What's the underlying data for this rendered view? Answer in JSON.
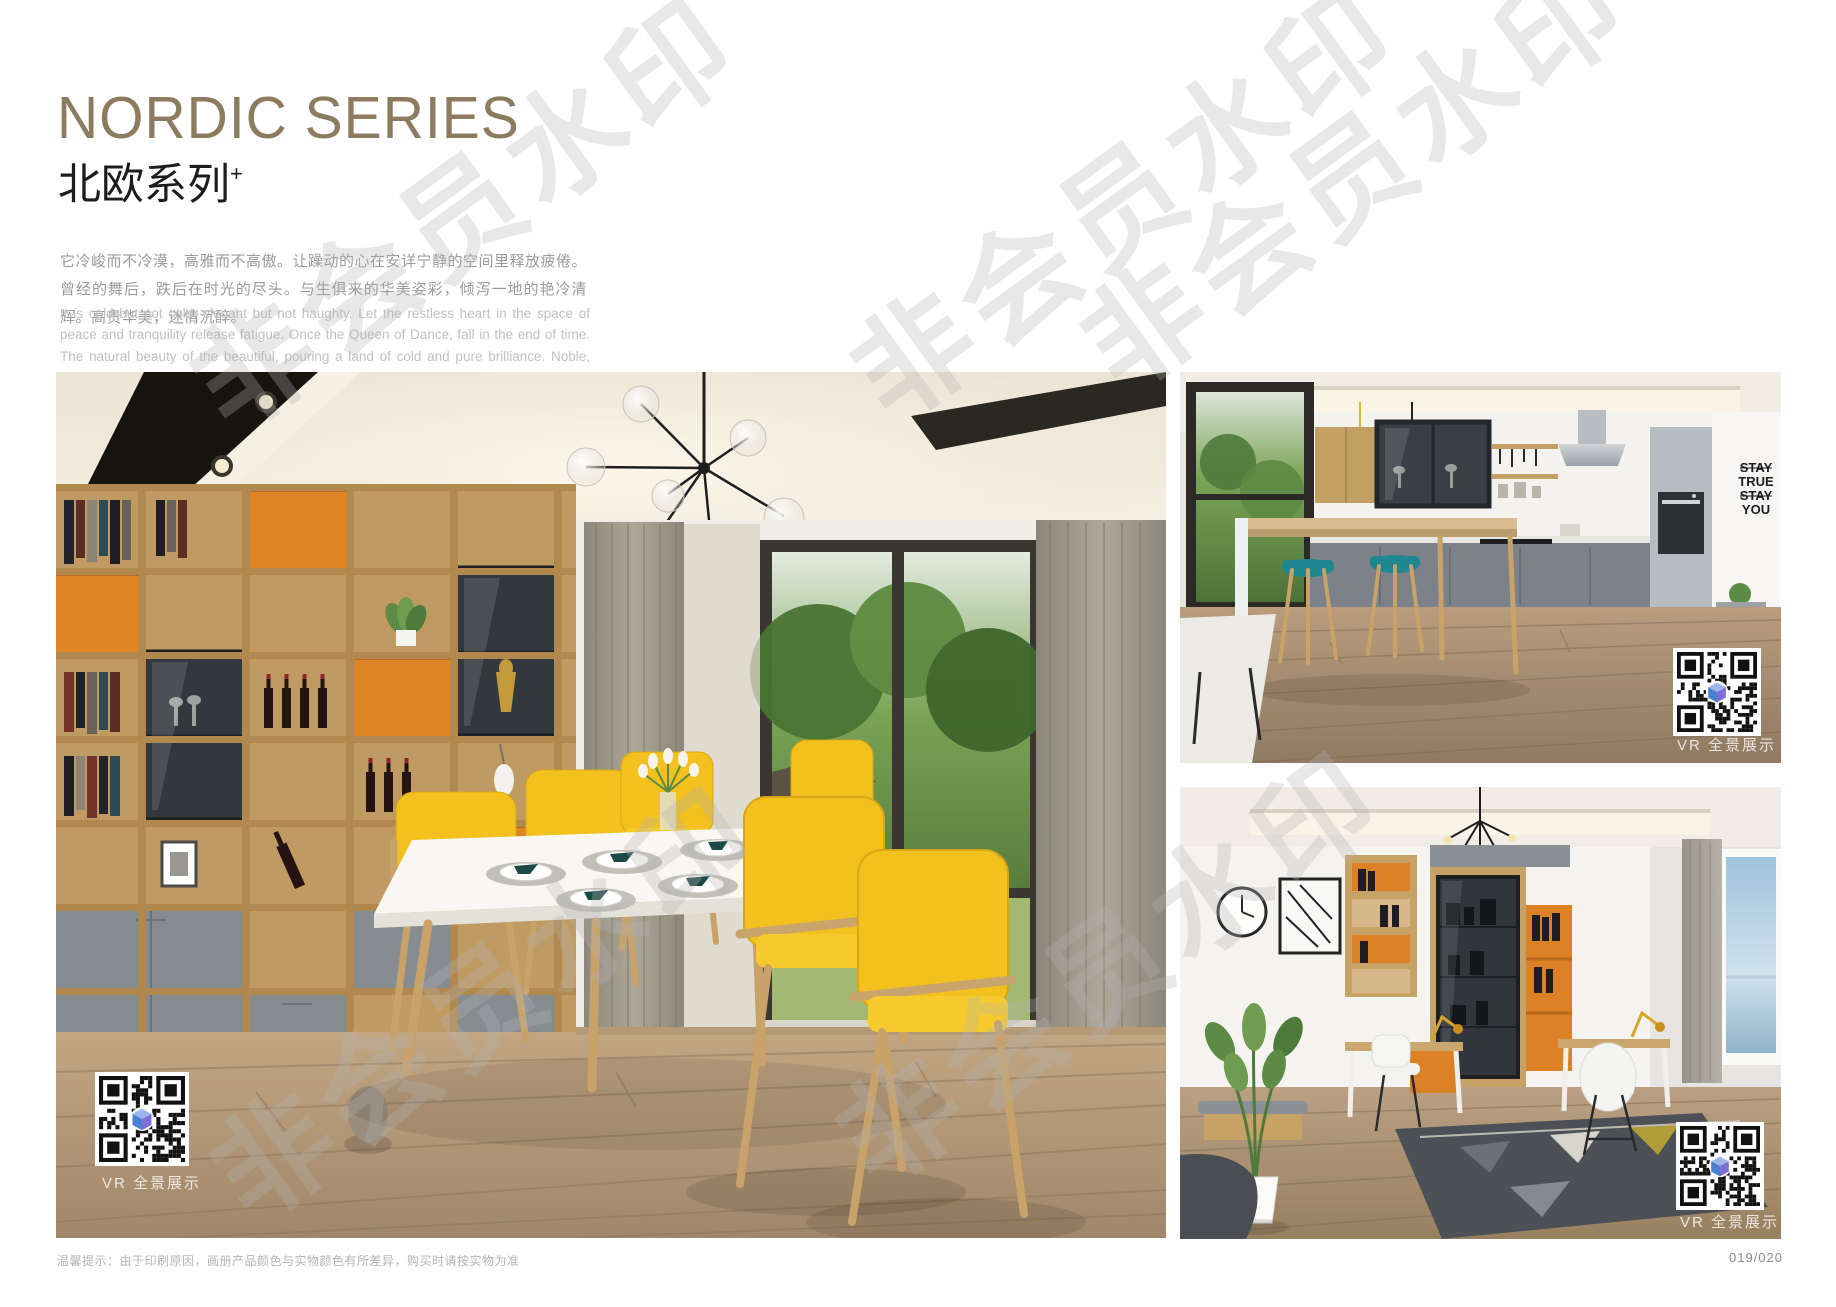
{
  "header": {
    "title_en": "NORDIC SERIES",
    "title_cn": "北欧系列",
    "title_superscript": "+",
    "desc_cn": "它冷峻而不冷漠，高雅而不高傲。让躁动的心在安详宁静的空间里释放疲倦。曾经的舞后，跌后在时光的尽头。与生俱来的华美姿彩，倾泻一地的艳冷清辉。高贵华美，迷情沉醉。",
    "desc_en": "It is cold but not cold, elegant but not haughty. Let the restless heart in the space of peace and tranquility release fatigue. Once the Queen of Dance, fall in the end of time. The natural beauty of the beautiful, pouring a land of cold and pure brilliance. Noble, beautiful, enchanted."
  },
  "gallery": {
    "vr_label": "VR 全景展示",
    "photos": [
      {
        "name": "dining-room",
        "desc": "Nordic dining room with wood shelving wall, yellow chairs and white table"
      },
      {
        "name": "kitchen",
        "desc": "Open kitchen with bar counter, teal stools and wood cabinets"
      },
      {
        "name": "study",
        "desc": "Study room with display cabinet, desks and geometric rug"
      }
    ],
    "wall_art": [
      "STAY",
      "TRUE",
      "STAY",
      "YOU"
    ]
  },
  "watermark": {
    "text": "非会员水印"
  },
  "footer": {
    "note": "温馨提示：由于印刷原因，画册产品颜色与实物颜色有所差异，购买时请按实物为准",
    "page_number": "019/020"
  },
  "colors": {
    "title": "#8c7b5f",
    "accent_orange": "#e08526",
    "accent_yellow": "#f2c11d",
    "accent_teal": "#1f8792",
    "wood": "#c49f6b",
    "cabinet_gray": "#878c91"
  }
}
